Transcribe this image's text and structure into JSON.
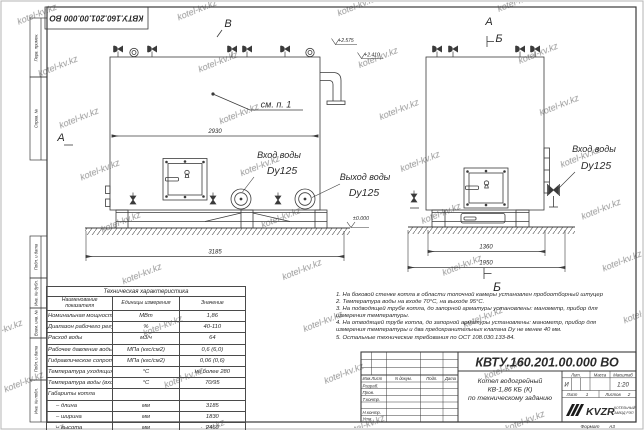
{
  "watermark": "kotel-kv.kz",
  "frame": {
    "doc_number_flipped": "КВТУ.160.201.00.000 ВО",
    "margin_cells_top": [
      "Перв. примен.",
      "Справ. №"
    ],
    "margin_cells_bottom": [
      "Подп. и дата",
      "Инв. № дубл.",
      "Взам. инв. №",
      "Подп. и дата",
      "Инв. № подл."
    ],
    "format_label": "Формат",
    "format_value": "А3"
  },
  "drawing": {
    "view_b": "В",
    "section_a": "А",
    "view_a": "А",
    "section_b": "Б",
    "section_b_mark": "Б",
    "see_item": "см. п. 1",
    "inlet_label": "Вход воды",
    "outlet_label": "Выход воды",
    "dn_label": "Dy125",
    "dim_width": "2930",
    "dim_length": "3185",
    "dim_depth_frame": "1360",
    "dim_depth_total": "1950",
    "level_zero": "±0.000",
    "level_top": "+2.575",
    "level_flue": "+2.410"
  },
  "tech_table": {
    "title": "Техническая характеристика",
    "headers": [
      "Наименование показателя",
      "Единицы измерения",
      "Значение"
    ],
    "rows": [
      {
        "name": "Номинальная мощность",
        "unit": "МВт",
        "value": "1,86"
      },
      {
        "name": "Диапазон рабочего регулирования",
        "unit": "%",
        "value": "40-110"
      },
      {
        "name": "Расход воды",
        "unit": "м3/ч",
        "value": "64"
      },
      {
        "name": "Рабочее давление воды",
        "unit": "МПа (кгс/см2)",
        "value": "0,6 (6,0)"
      },
      {
        "name": "Гидравлическое сопротивление котла",
        "unit": "МПа (кгс/см2)",
        "value": "0,06 (0,6)"
      },
      {
        "name": "Температура уходящих газов",
        "unit": "°С",
        "value": "не более 280"
      },
      {
        "name": "Температура воды (вход/выход)",
        "unit": "°С",
        "value": "70/95"
      },
      {
        "name": "Габариты котла",
        "unit": "",
        "value": ""
      },
      {
        "name": "– длина",
        "unit": "мм",
        "value": "3185"
      },
      {
        "name": "– ширина",
        "unit": "мм",
        "value": "1830"
      },
      {
        "name": "– высота",
        "unit": "мм",
        "value": "2460"
      }
    ]
  },
  "notes": {
    "items": [
      "1. На боковой стенке котла в области топочной камеры установлен пробоотборный штуцер",
      "2. Температура воды на входе 70°С, на выходе 95°С.",
      "3. На подводящей трубе котла, до запорной арматуры установлены: манометр, прибор для измерения температуры.",
      "4. На отводящей трубе котла, до запорной арматуры установлены: манометр, прибор для измерения температуры и два предохранительных клапана Dу не менее 40 мм.",
      "5. Остальные технические требования по ОСТ 108.030.133-84."
    ]
  },
  "title_block": {
    "doc_number": "КВТУ.160.201.00.000 ВО",
    "rev_header": [
      "Изм.Лист",
      "N докум.",
      "Подп.",
      "Дата"
    ],
    "rev_rows": [
      "Разраб.",
      "Пров.",
      "Т.контр.",
      "Н.контр.",
      "Утв."
    ],
    "product_title": [
      "Котел водогрейный",
      "КВ-1,86 КБ (К)",
      "по техническому заданию"
    ],
    "lit_label": "Лит.",
    "mass_label": "Масса",
    "scale_label": "Масштаб",
    "lit_value": "И",
    "scale_value": "1:20",
    "sheet_label": "Лист",
    "sheet_value": "1",
    "sheets_label": "Листов",
    "sheets_value": "2",
    "logo_text": "KVZR",
    "company_line1": "КОТЕЛЬНЫЙ",
    "company_line2": "ЗАВОД РЭП"
  }
}
